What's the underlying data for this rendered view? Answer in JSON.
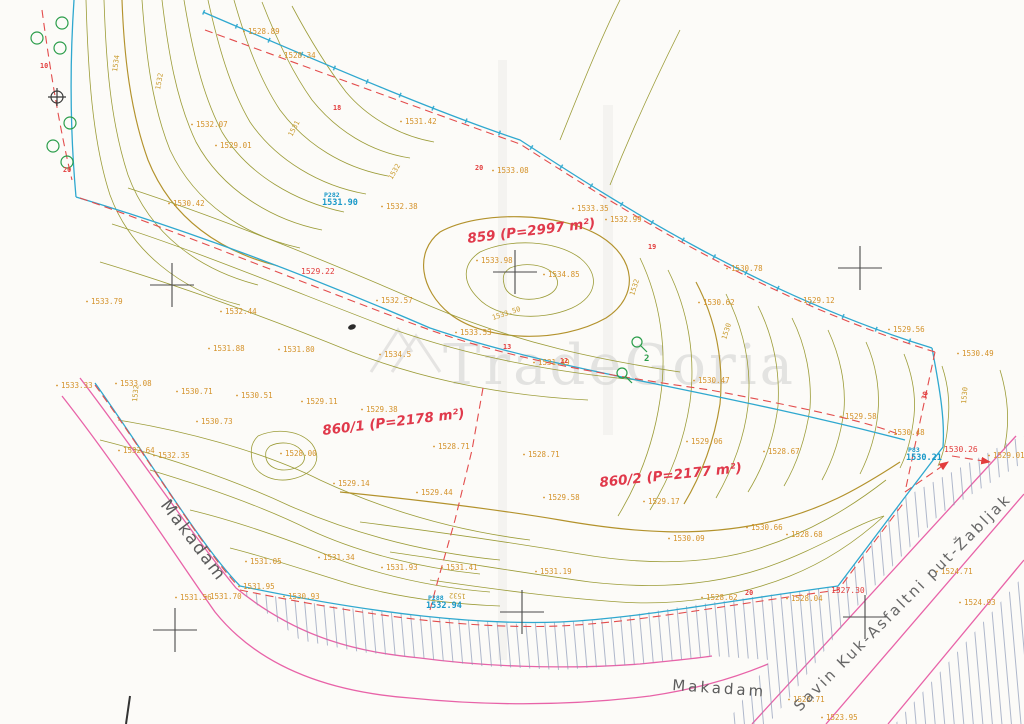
{
  "watermark": {
    "text": "TradeGoria"
  },
  "colors": {
    "contour": "#9c9c38",
    "index_contour": "#b3922c",
    "boundary_cyan": "#2fa8cf",
    "boundary_red": "#e34c4c",
    "road_pink": "#e863a8",
    "spot_orange": "#d4922a",
    "vegetation_green": "#2a9d4a",
    "paper": "#fcfbf8"
  },
  "parcels": [
    {
      "label": "859 (P=2997 m²)",
      "x": 468,
      "y": 243,
      "rot": -7
    },
    {
      "label": "860/1 (P=2178 m²)",
      "x": 323,
      "y": 435,
      "rot": -7
    },
    {
      "label": "860/2 (P=2177 m²)",
      "x": 600,
      "y": 487,
      "rot": -6
    }
  ],
  "roads": [
    {
      "label": "Makadam",
      "x": 160,
      "y": 505,
      "rot": 53,
      "cls": "road"
    },
    {
      "label": "Makadam",
      "x": 672,
      "y": 690,
      "rot": 4,
      "cls": "road small"
    },
    {
      "label": "Savin Kuk-Asfaltni put-Žabljak",
      "x": 800,
      "y": 712,
      "rot": -45,
      "cls": "savin"
    }
  ],
  "benchmarks": [
    {
      "id": "P282",
      "elev": "1531.90",
      "x": 324,
      "y": 197
    },
    {
      "id": "P288",
      "elev": "1532.94",
      "x": 428,
      "y": 600
    },
    {
      "id": "P83",
      "elev": "1530.21",
      "x": 908,
      "y": 452
    }
  ],
  "spot_heights": [
    {
      "t": "1528.89",
      "x": 248,
      "y": 34
    },
    {
      "t": "1528.34",
      "x": 284,
      "y": 58
    },
    {
      "t": "1531.42",
      "x": 405,
      "y": 124
    },
    {
      "t": "1533.08",
      "x": 497,
      "y": 173
    },
    {
      "t": "1532.38",
      "x": 386,
      "y": 209
    },
    {
      "t": "1533.35",
      "x": 577,
      "y": 211
    },
    {
      "t": "1532.99",
      "x": 610,
      "y": 222
    },
    {
      "t": "1532.07",
      "x": 196,
      "y": 127
    },
    {
      "t": "1529.01",
      "x": 220,
      "y": 148
    },
    {
      "t": "1530.42",
      "x": 173,
      "y": 206
    },
    {
      "t": "1533.79",
      "x": 91,
      "y": 304
    },
    {
      "t": "1532.44",
      "x": 225,
      "y": 314
    },
    {
      "t": "1532.57",
      "x": 381,
      "y": 303
    },
    {
      "t": "1533.98",
      "x": 481,
      "y": 263
    },
    {
      "t": "1534.85",
      "x": 548,
      "y": 277
    },
    {
      "t": "1530.78",
      "x": 731,
      "y": 271
    },
    {
      "t": "1530.62",
      "x": 703,
      "y": 305
    },
    {
      "t": "1529.12",
      "x": 803,
      "y": 303
    },
    {
      "t": "1529.56",
      "x": 893,
      "y": 332
    },
    {
      "t": "1530.49",
      "x": 962,
      "y": 356
    },
    {
      "t": "1531.88",
      "x": 213,
      "y": 351
    },
    {
      "t": "1531.80",
      "x": 283,
      "y": 352
    },
    {
      "t": "1533.53",
      "x": 460,
      "y": 335
    },
    {
      "t": "1534.5",
      "x": 384,
      "y": 357
    },
    {
      "t": "1531.49",
      "x": 538,
      "y": 365
    },
    {
      "t": "1530.47",
      "x": 698,
      "y": 383
    },
    {
      "t": "1533.33",
      "x": 61,
      "y": 388
    },
    {
      "t": "1533.08",
      "x": 120,
      "y": 386
    },
    {
      "t": "1530.71",
      "x": 181,
      "y": 394
    },
    {
      "t": "1530.51",
      "x": 241,
      "y": 398
    },
    {
      "t": "1529.11",
      "x": 306,
      "y": 404
    },
    {
      "t": "1530.73",
      "x": 201,
      "y": 424
    },
    {
      "t": "1532.64",
      "x": 123,
      "y": 453
    },
    {
      "t": "1532.35",
      "x": 158,
      "y": 458
    },
    {
      "t": "1528.00",
      "x": 285,
      "y": 456
    },
    {
      "t": "1529.38",
      "x": 366,
      "y": 412
    },
    {
      "t": "1528.71",
      "x": 438,
      "y": 449
    },
    {
      "t": "1528.71",
      "x": 528,
      "y": 457
    },
    {
      "t": "1529.14",
      "x": 338,
      "y": 486
    },
    {
      "t": "1529.44",
      "x": 421,
      "y": 495
    },
    {
      "t": "1529.58",
      "x": 548,
      "y": 500
    },
    {
      "t": "1529.06",
      "x": 691,
      "y": 444
    },
    {
      "t": "1528.67",
      "x": 768,
      "y": 454
    },
    {
      "t": "1529.17",
      "x": 648,
      "y": 504
    },
    {
      "t": "1530.09",
      "x": 673,
      "y": 541
    },
    {
      "t": "1530.66",
      "x": 751,
      "y": 530
    },
    {
      "t": "1528.68",
      "x": 791,
      "y": 537
    },
    {
      "t": "1531.05",
      "x": 250,
      "y": 564
    },
    {
      "t": "1531.34",
      "x": 323,
      "y": 560
    },
    {
      "t": "1531.93",
      "x": 386,
      "y": 570
    },
    {
      "t": "1531.95",
      "x": 243,
      "y": 589
    },
    {
      "t": "1531.56",
      "x": 180,
      "y": 600
    },
    {
      "t": "1531.70",
      "x": 210,
      "y": 599
    },
    {
      "t": "1530.93",
      "x": 288,
      "y": 599
    },
    {
      "t": "1531.41",
      "x": 446,
      "y": 570
    },
    {
      "t": "1531.19",
      "x": 540,
      "y": 574
    },
    {
      "t": "1529.58",
      "x": 845,
      "y": 419
    },
    {
      "t": "1530.48",
      "x": 893,
      "y": 435
    },
    {
      "t": "1529.01",
      "x": 993,
      "y": 458
    },
    {
      "t": "1524.71",
      "x": 941,
      "y": 574
    },
    {
      "t": "1524.93",
      "x": 964,
      "y": 605
    },
    {
      "t": "1523.71",
      "x": 793,
      "y": 702
    },
    {
      "t": "1523.95",
      "x": 826,
      "y": 720
    },
    {
      "t": "1528.04",
      "x": 791,
      "y": 601
    },
    {
      "t": "1528.62",
      "x": 706,
      "y": 600
    }
  ],
  "red_spots": [
    {
      "t": "1529.22",
      "x": 301,
      "y": 274
    },
    {
      "t": "1527.30",
      "x": 831,
      "y": 593
    },
    {
      "t": "1530.26",
      "x": 944,
      "y": 452
    }
  ],
  "point_numbers": [
    {
      "t": "10",
      "x": 40,
      "y": 68
    },
    {
      "t": "20",
      "x": 63,
      "y": 172
    },
    {
      "t": "18",
      "x": 333,
      "y": 110
    },
    {
      "t": "20",
      "x": 475,
      "y": 170
    },
    {
      "t": "19",
      "x": 648,
      "y": 249
    },
    {
      "t": "13",
      "x": 503,
      "y": 349
    },
    {
      "t": "12",
      "x": 560,
      "y": 363
    },
    {
      "t": "30",
      "x": 926,
      "y": 400,
      "rot": -75
    },
    {
      "t": "20",
      "x": 745,
      "y": 595
    }
  ],
  "contour_labels": [
    {
      "t": "1534",
      "x": 117,
      "y": 72,
      "rot": -82
    },
    {
      "t": "1532",
      "x": 160,
      "y": 90,
      "rot": -80
    },
    {
      "t": "1531",
      "x": 292,
      "y": 137,
      "rot": -62
    },
    {
      "t": "1532",
      "x": 392,
      "y": 180,
      "rot": -60
    },
    {
      "t": "1533.50",
      "x": 493,
      "y": 320,
      "rot": -18
    },
    {
      "t": "1532",
      "x": 634,
      "y": 296,
      "rot": -72
    },
    {
      "t": "1530",
      "x": 726,
      "y": 340,
      "rot": -72
    },
    {
      "t": "1530",
      "x": 966,
      "y": 404,
      "rot": -85
    },
    {
      "t": "1532",
      "x": 466,
      "y": 594,
      "rot": 183
    },
    {
      "t": "1532",
      "x": 137,
      "y": 402,
      "rot": -85
    }
  ],
  "green_labels": [
    {
      "t": "2",
      "x": 644,
      "y": 361
    }
  ]
}
